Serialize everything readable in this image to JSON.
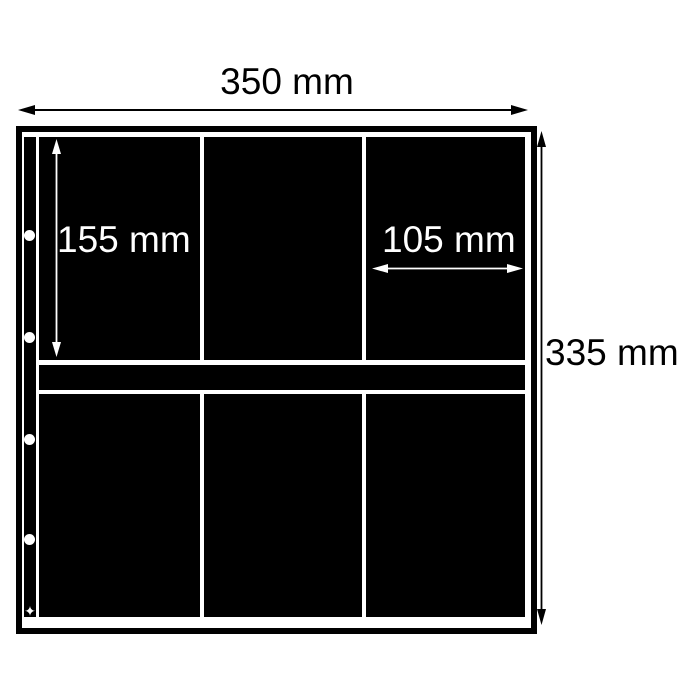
{
  "annotations": {
    "sheet_width": {
      "label": "350 mm"
    },
    "pocket_height": {
      "label": "155 mm"
    },
    "pocket_width": {
      "label": "105 mm"
    },
    "sheet_height": {
      "label": "335 mm"
    }
  },
  "sheet": {
    "rows": 2,
    "columns": 3,
    "pocket_count": 6,
    "binder_hole_count": 4,
    "punch_mark_glyph": "✦"
  },
  "colors": {
    "background": "#ffffff",
    "sheet": "#000000",
    "inner_label": "#ffffff",
    "outer_label": "#000000"
  }
}
